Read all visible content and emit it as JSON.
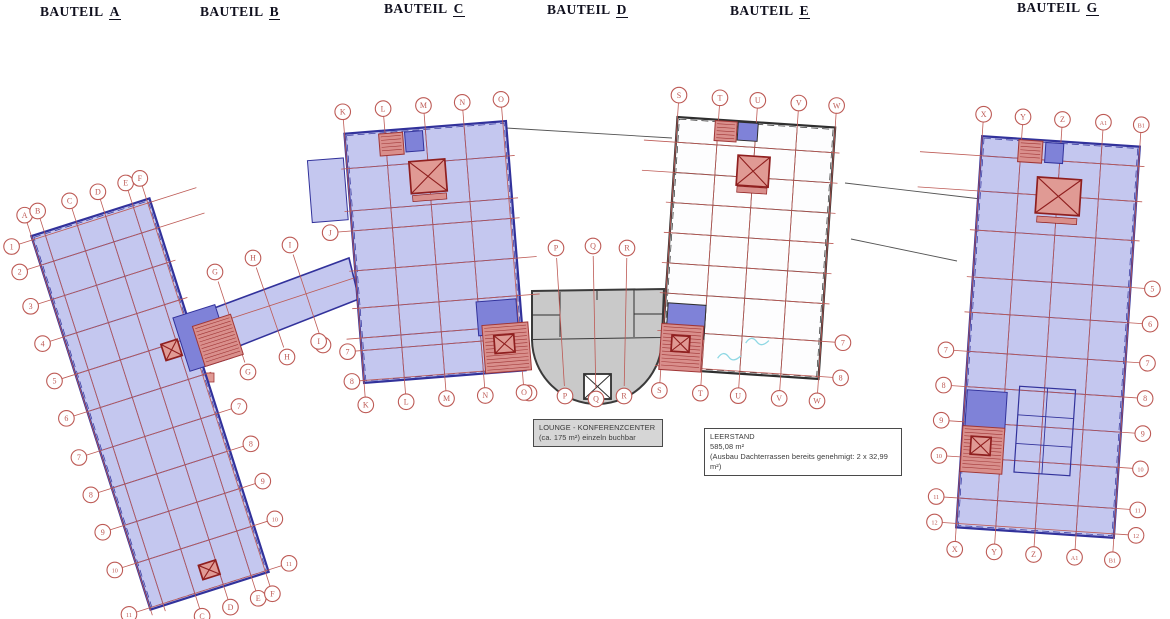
{
  "page": {
    "title": "Grundriss-Übersicht Bauteile",
    "background": "#ffffff"
  },
  "headers": [
    {
      "prefix": "BAUTEIL",
      "letter": "A",
      "x": 40,
      "y": 4
    },
    {
      "prefix": "BAUTEIL",
      "letter": "B",
      "x": 200,
      "y": 4
    },
    {
      "prefix": "BAUTEIL",
      "letter": "C",
      "x": 384,
      "y": 1
    },
    {
      "prefix": "BAUTEIL",
      "letter": "D",
      "x": 547,
      "y": 2
    },
    {
      "prefix": "BAUTEIL",
      "letter": "E",
      "x": 730,
      "y": 3
    },
    {
      "prefix": "BAUTEIL",
      "letter": "G",
      "x": 1017,
      "y": 0
    }
  ],
  "annotations": {
    "lounge": {
      "line1": "LOUNGE - KONFERENZCENTER",
      "line2": "(ca. 175 m²) einzeln buchbar"
    },
    "leerstand": {
      "line1": "LEERSTAND",
      "line2": "585,08 m²",
      "line3": "(Ausbau Dachterrassen bereits genehmigt: 2 x 32,99 m²)"
    }
  },
  "colors": {
    "floor_blue": "#c4c7ef",
    "floor_white": "#fdfdfe",
    "floor_gray": "#c9c9c9",
    "wall_navy": "#32329b",
    "wall_dark": "#2f2f2f",
    "gray_border": "#3a3a3a",
    "grid_red": "#bd5a55",
    "circle_red": "#bd5a55",
    "lobby_blue": "#7f82d8",
    "stair_red": "#d98f8c",
    "core_red": "#e09a94",
    "core_border": "#8f1f1f",
    "hatch_red": "#a03636",
    "cyan": "#8fd8e4",
    "connector": "#555555"
  },
  "connectors": [
    [
      506,
      128,
      672,
      138
    ],
    [
      845,
      183,
      981,
      199
    ],
    [
      851,
      239,
      957,
      261
    ]
  ],
  "bridge": {
    "id": "B",
    "poly": [
      [
        190,
        317
      ],
      [
        349,
        258
      ],
      [
        359,
        299
      ],
      [
        201,
        361
      ]
    ],
    "axis": [
      196,
      330,
      354,
      278
    ],
    "lines": [
      {
        "label": "G",
        "top": [
          215,
          272
        ],
        "bottom": [
          248,
          372
        ]
      },
      {
        "label": "H",
        "top": [
          253,
          258
        ],
        "bottom": [
          287,
          357
        ]
      },
      {
        "label": "I",
        "top": [
          290,
          245
        ],
        "bottom": [
          323,
          345
        ]
      }
    ],
    "extra_rects": [
      {
        "x": 192,
        "y": 373,
        "w": 22,
        "h": 9
      }
    ]
  },
  "building_d": {
    "id": "D",
    "body": [
      [
        532,
        291
      ],
      [
        664,
        289
      ],
      [
        662,
        338
      ],
      [
        532,
        340
      ]
    ],
    "arc": {
      "x1": 532,
      "y1": 340,
      "x2": 662,
      "y2": 338,
      "r": 65
    },
    "inner_lines": [
      [
        560,
        292,
        560,
        337
      ],
      [
        634,
        290,
        634,
        337
      ],
      [
        532,
        315,
        560,
        315
      ],
      [
        634,
        314,
        662,
        314
      ],
      [
        597,
        291,
        597,
        300
      ]
    ],
    "elevator": {
      "x": 584,
      "y": 374,
      "w": 27,
      "h": 25
    },
    "grid_lines": [
      {
        "label": "P",
        "top": [
          556,
          248
        ],
        "bottom": [
          565,
          396
        ]
      },
      {
        "label": "Q",
        "top": [
          593,
          246
        ],
        "bottom": [
          596,
          399
        ]
      },
      {
        "label": "R",
        "top": [
          627,
          248
        ],
        "bottom": [
          624,
          396
        ]
      }
    ],
    "extra_circles": [
      {
        "label": "O",
        "x": 529,
        "y": 393
      }
    ]
  },
  "buildings": [
    {
      "id": "A",
      "cx": 150,
      "cy": 404,
      "w": 124,
      "h": 392,
      "rot": -17.7,
      "fill": "floor_blue",
      "wall": "wall_navy",
      "cols": [
        {
          "label": "A",
          "t": 0.0,
          "top": true
        },
        {
          "label": "B",
          "t": 0.11,
          "top": true
        },
        {
          "label": "C",
          "t": 0.38,
          "top": true,
          "bottom": true
        },
        {
          "label": "D",
          "t": 0.62,
          "top": true,
          "bottom": true
        },
        {
          "label": "E",
          "t": 0.855,
          "top": true,
          "bottom": true
        },
        {
          "label": "F",
          "t": 0.975,
          "top": true,
          "bottom": true
        }
      ],
      "rows": [
        {
          "t": 0.01,
          "left": "1",
          "rx": 42
        },
        {
          "t": 0.078,
          "left": "2",
          "rx": 42
        },
        {
          "t": 0.17,
          "left": "3"
        },
        {
          "t": 0.27,
          "left": "4"
        },
        {
          "t": 0.37,
          "left": "5"
        },
        {
          "t": 0.47,
          "left": "6"
        },
        {
          "t": 0.575,
          "left": "7",
          "right": "7"
        },
        {
          "t": 0.675,
          "left": "8",
          "right": "8"
        },
        {
          "t": 0.775,
          "left": "9",
          "right": "9"
        },
        {
          "t": 0.876,
          "left": "10",
          "right": "10"
        },
        {
          "t": 0.995,
          "left": "11",
          "right": "11"
        }
      ],
      "features": [
        {
          "type": "lobby",
          "x": 70,
          "y": -47,
          "w": 44,
          "h": 56
        },
        {
          "type": "stair",
          "x": 84,
          "y": -40,
          "w": 40,
          "h": 42
        },
        {
          "type": "core",
          "x": 37,
          "y": -45,
          "w": 17,
          "h": 17
        },
        {
          "type": "core",
          "x": 6,
          "y": 176,
          "w": 18,
          "h": 15
        }
      ]
    },
    {
      "id": "C",
      "cx": 435,
      "cy": 252,
      "w": 162,
      "h": 250,
      "rot": -4.5,
      "fill": "floor_blue",
      "wall": "wall_navy",
      "cols": [
        {
          "label": "K",
          "t": 0.0,
          "top": true,
          "bottom": true
        },
        {
          "label": "L",
          "t": 0.25,
          "top": true,
          "bottom": true
        },
        {
          "label": "M",
          "t": 0.5,
          "top": true,
          "bottom": true
        },
        {
          "label": "N",
          "t": 0.74,
          "top": true,
          "bottom": true
        },
        {
          "label": "O",
          "t": 0.98,
          "top": true,
          "bottom": true
        }
      ],
      "rows": [
        {
          "t": 0.14
        },
        {
          "t": 0.31
        },
        {
          "t": 0.39,
          "left": "J"
        },
        {
          "t": 0.55,
          "rx": 14
        },
        {
          "t": 0.7,
          "rx": 14
        },
        {
          "t": 0.82,
          "left": "I",
          "lext": 20
        },
        {
          "t": 0.87,
          "left": "7",
          "lext": -8
        },
        {
          "t": 0.99,
          "left": "8",
          "lext": -10
        }
      ],
      "features": [
        {
          "type": "wing",
          "x": -102,
          "y": -70,
          "w": 36,
          "h": 62
        },
        {
          "type": "stair",
          "x": -35,
          "y": -111,
          "w": 24,
          "h": 22
        },
        {
          "type": "lobby",
          "x": -12,
          "y": -112,
          "w": 18,
          "h": 20
        },
        {
          "type": "core",
          "x": -1,
          "y": -76,
          "w": 36,
          "h": 32
        },
        {
          "type": "bar",
          "x": -1,
          "y": -55,
          "w": 34,
          "h": 6
        },
        {
          "type": "lobby",
          "x": 57,
          "y": 70,
          "w": 40,
          "h": 34
        },
        {
          "type": "stair",
          "x": 64,
          "y": 101,
          "w": 46,
          "h": 48
        },
        {
          "type": "core",
          "x": 62,
          "y": 97,
          "w": 20,
          "h": 18
        }
      ]
    },
    {
      "id": "E",
      "cx": 748,
      "cy": 248,
      "w": 158,
      "h": 252,
      "rot": 3.8,
      "fill": "floor_white",
      "wall": "wall_dark",
      "cols": [
        {
          "label": "S",
          "t": 0.0,
          "top": true,
          "bottom": true
        },
        {
          "label": "T",
          "t": 0.26,
          "top": true,
          "bottom": true
        },
        {
          "label": "U",
          "t": 0.5,
          "top": true,
          "bottom": true
        },
        {
          "label": "V",
          "t": 0.76,
          "top": true,
          "bottom": true
        },
        {
          "label": "W",
          "t": 1.0,
          "top": true,
          "bottom": true
        }
      ],
      "rows": [
        {
          "t": 0.1,
          "lx": 26
        },
        {
          "t": 0.22,
          "lx": 26
        },
        {
          "t": 0.34
        },
        {
          "t": 0.46
        },
        {
          "t": 0.58
        },
        {
          "t": 0.7
        },
        {
          "t": 0.85,
          "right": "7"
        },
        {
          "t": 0.99,
          "right": "8"
        }
      ],
      "features": [
        {
          "type": "stair",
          "x": -30,
          "y": -115,
          "w": 22,
          "h": 20
        },
        {
          "type": "lobby",
          "x": -8,
          "y": -116,
          "w": 20,
          "h": 18
        },
        {
          "type": "core",
          "x": 0,
          "y": -77,
          "w": 32,
          "h": 30
        },
        {
          "type": "bar",
          "x": 0,
          "y": -58,
          "w": 30,
          "h": 6
        },
        {
          "type": "lobby",
          "x": -57,
          "y": 77,
          "w": 38,
          "h": 34
        },
        {
          "type": "stair",
          "x": -60,
          "y": 104,
          "w": 42,
          "h": 46
        },
        {
          "type": "core",
          "x": -61,
          "y": 100,
          "w": 18,
          "h": 16
        },
        {
          "type": "squiggle",
          "x": 15,
          "y": 95
        },
        {
          "type": "squiggle",
          "x": -12,
          "y": 112
        }
      ]
    },
    {
      "id": "G",
      "cx": 1048,
      "cy": 337,
      "w": 158,
      "h": 392,
      "rot": 3.8,
      "fill": "floor_blue",
      "wall": "wall_navy",
      "cols": [
        {
          "label": "X",
          "t": 0.0,
          "top": true,
          "bottom": true
        },
        {
          "label": "Y",
          "t": 0.25,
          "top": true,
          "bottom": true
        },
        {
          "label": "Z",
          "t": 0.5,
          "top": true,
          "bottom": true
        },
        {
          "label": "A1",
          "t": 0.76,
          "top": true,
          "bottom": true
        },
        {
          "label": "B1",
          "t": 1.0,
          "top": true,
          "bottom": true
        }
      ],
      "rows": [
        {
          "t": 0.05,
          "lx": 55
        },
        {
          "t": 0.14,
          "lx": 55
        },
        {
          "t": 0.24
        },
        {
          "t": 0.36,
          "right": "5"
        },
        {
          "t": 0.45,
          "right": "6"
        },
        {
          "t": 0.55,
          "left": "7",
          "right": "7"
        },
        {
          "t": 0.64,
          "left": "8",
          "right": "8"
        },
        {
          "t": 0.73,
          "left": "9",
          "right": "9"
        },
        {
          "t": 0.82,
          "left": "10",
          "right": "10"
        },
        {
          "t": 0.925,
          "left": "11",
          "right": "11"
        },
        {
          "t": 0.99,
          "left": "12",
          "right": "12"
        }
      ],
      "features": [
        {
          "type": "stair",
          "x": -30,
          "y": -184,
          "w": 24,
          "h": 22
        },
        {
          "type": "lobby",
          "x": -6,
          "y": -184,
          "w": 18,
          "h": 20
        },
        {
          "type": "core",
          "x": 1,
          "y": -141,
          "w": 44,
          "h": 36
        },
        {
          "type": "bar",
          "x": 1,
          "y": -117,
          "w": 40,
          "h": 6
        },
        {
          "type": "lobby",
          "x": -57,
          "y": 79,
          "w": 40,
          "h": 42
        },
        {
          "type": "stair",
          "x": -58,
          "y": 117,
          "w": 42,
          "h": 46
        },
        {
          "type": "core",
          "x": -60,
          "y": 113,
          "w": 20,
          "h": 18
        },
        {
          "type": "rooms",
          "x": 3,
          "y": 94,
          "w": 56,
          "h": 86
        }
      ]
    }
  ]
}
